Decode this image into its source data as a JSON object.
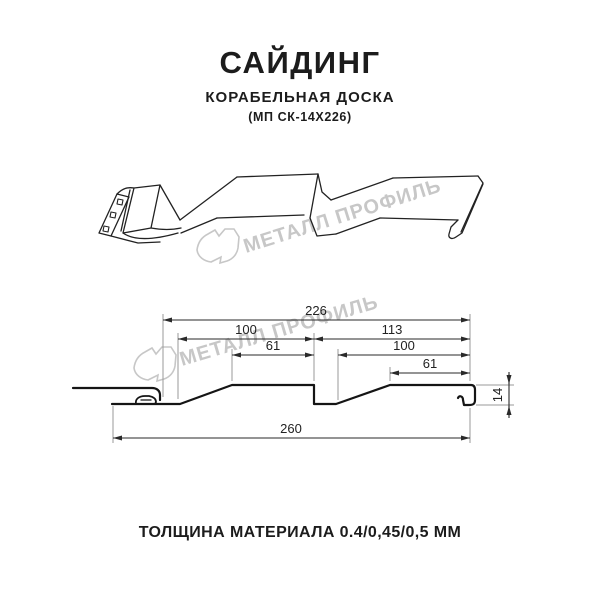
{
  "header": {
    "title": "САЙДИНГ",
    "subtitle": "КОРАБЕЛЬНАЯ ДОСКА",
    "code": "(МП СК-14Х226)"
  },
  "footer": {
    "thickness_label": "ТОЛЩИНА МАТЕРИАЛА 0.4/0,45/0,5 ММ"
  },
  "watermark": {
    "brand_text": "МЕТАЛЛ ПРОФИЛЬ",
    "color": "#c7c7c7"
  },
  "drawing": {
    "dimensions_mm": {
      "overall_visible_width": "226",
      "left_board_width": "100",
      "left_board_flat": "61",
      "right_section_width": "113",
      "right_board_width": "100",
      "right_board_flat": "61",
      "total_width": "260",
      "profile_height": "14"
    },
    "colors": {
      "sketch_line": "#222222",
      "profile_line": "#151515",
      "dimension_line": "#2a2a2a",
      "extension_line": "#9a9a9a"
    }
  }
}
